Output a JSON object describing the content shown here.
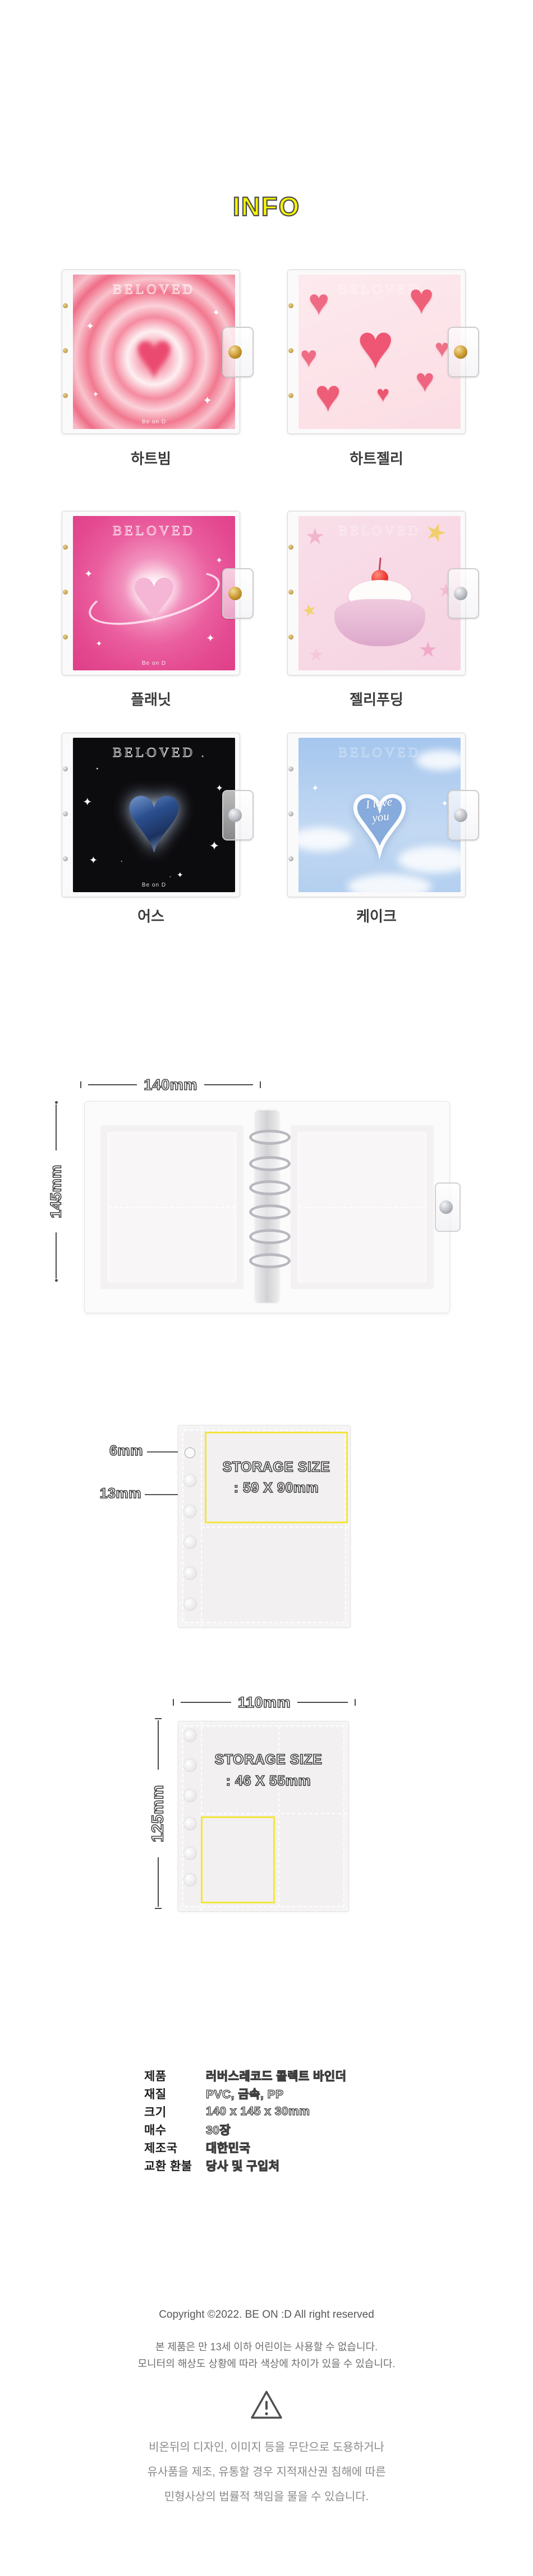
{
  "page": {
    "title": "INFO"
  },
  "colors": {
    "title_yellow": "#f6f400",
    "highlight_yellow": "#f3e63a"
  },
  "products": [
    {
      "name": "하트빔",
      "cover_text": "BELOVED",
      "cover_brand": "Be on D"
    },
    {
      "name": "하트젤리",
      "cover_text": "BELOVED"
    },
    {
      "name": "플래닛",
      "cover_text": "BELOVED",
      "cover_brand": "Be on D"
    },
    {
      "name": "젤리푸딩",
      "cover_text": "BELOVED"
    },
    {
      "name": "어스",
      "cover_text": "BELOVED",
      "cover_brand": "Be on D"
    },
    {
      "name": "케이크",
      "cover_text": "BELOVED",
      "cake_text": "I love\nyou"
    }
  ],
  "binder": {
    "width_label": "140mm",
    "height_label": "145mm"
  },
  "pocket1": {
    "hole_label": "6mm",
    "gap_label": "13mm",
    "storage_title": "STORAGE SIZE",
    "storage_value": ": 59 X 90mm"
  },
  "pocket2": {
    "width_label": "110mm",
    "height_label": "125mm",
    "storage_title": "STORAGE SIZE",
    "storage_value": ": 46 X 55mm"
  },
  "specs": {
    "rows": [
      {
        "label": "제품",
        "value": "러버스레코드 콜렉트 바인더"
      },
      {
        "label": "재질",
        "value": "PVC, 금속, PP"
      },
      {
        "label": "크기",
        "value": "140 x 145 x 30mm"
      },
      {
        "label": "매수",
        "value": "30장"
      },
      {
        "label": "제조국",
        "value": "대한민국"
      },
      {
        "label": "교환 환불",
        "value": "당사 및 구입처"
      }
    ]
  },
  "footer": {
    "copyright": "Copyright ©2022. BE ON :D All right reserved",
    "notices": [
      "본 제품은 만 13세 이하 어린이는 사용할 수 없습니다.",
      "모니터의 해상도 상황에 따라 색상에 차이가 있을 수 있습니다."
    ],
    "warnings": [
      "비온뒤의 디자인, 이미지 등을 무단으로 도용하거나",
      "유사품을 제조, 유통할 경우 지적재산권 침해에 따른",
      "민형사상의 법률적 책임을 물을 수 있습니다."
    ]
  }
}
